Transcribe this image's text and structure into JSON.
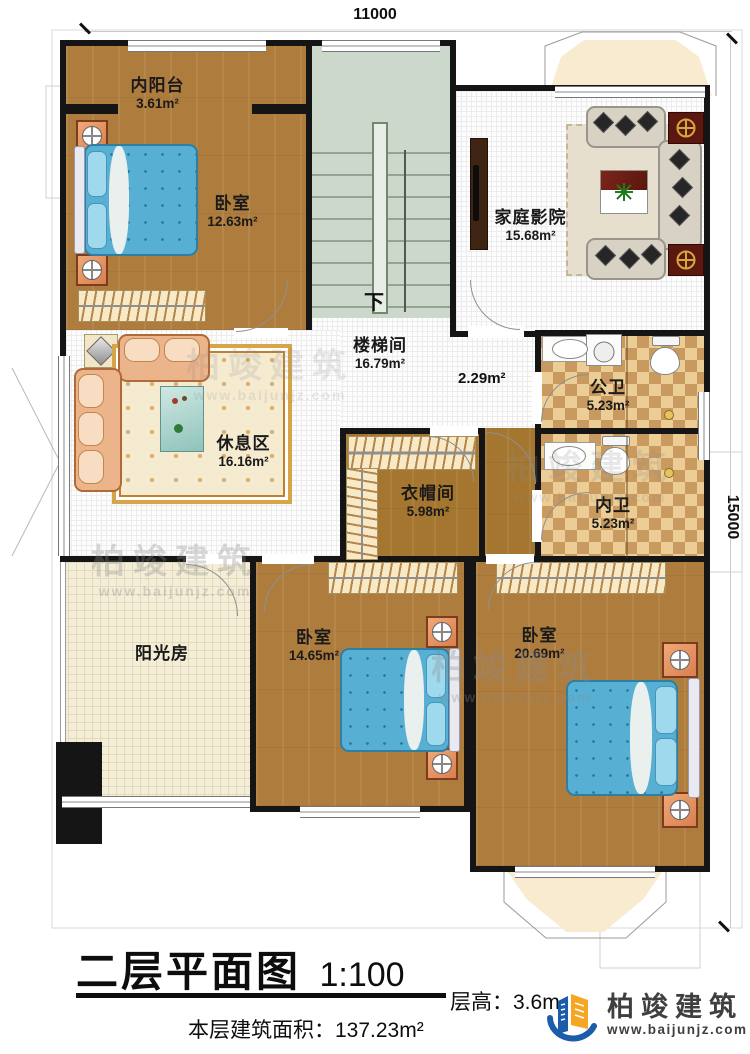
{
  "plan": {
    "dim_top": "11000",
    "dim_right": "15000",
    "rooms": {
      "inner_balcony": {
        "name": "内阳台",
        "area": "3.61m²"
      },
      "bedroom_top": {
        "name": "卧室",
        "area": "12.63m²"
      },
      "home_theater": {
        "name": "家庭影院",
        "area": "15.68m²"
      },
      "stairwell": {
        "name": "楼梯间",
        "area": "16.79m²"
      },
      "corridor": {
        "area": "2.29m²"
      },
      "public_bath": {
        "name": "公卫",
        "area": "5.23m²"
      },
      "inner_bath": {
        "name": "内卫",
        "area": "5.23m²"
      },
      "lounge": {
        "name": "休息区",
        "area": "16.16m²"
      },
      "cloakroom": {
        "name": "衣帽间",
        "area": "5.98m²"
      },
      "sunroom": {
        "name": "阳光房"
      },
      "bedroom_mid": {
        "name": "卧室",
        "area": "14.65m²"
      },
      "bedroom_master": {
        "name": "卧室",
        "area": "20.69m²"
      }
    },
    "stairs": {
      "down_label": "下"
    }
  },
  "titleblock": {
    "title": "二层平面图",
    "scale": "1:100",
    "floor_height": "层高：3.6m",
    "floor_area": "本层建筑面积：137.23m²"
  },
  "brand": {
    "name": "柏竣建筑",
    "website": "www.baijunjz.com",
    "blue": "#1b5cab",
    "orange": "#f5a623"
  },
  "watermark": {
    "name": "柏竣建筑",
    "website": "www.baijunjz.com"
  }
}
